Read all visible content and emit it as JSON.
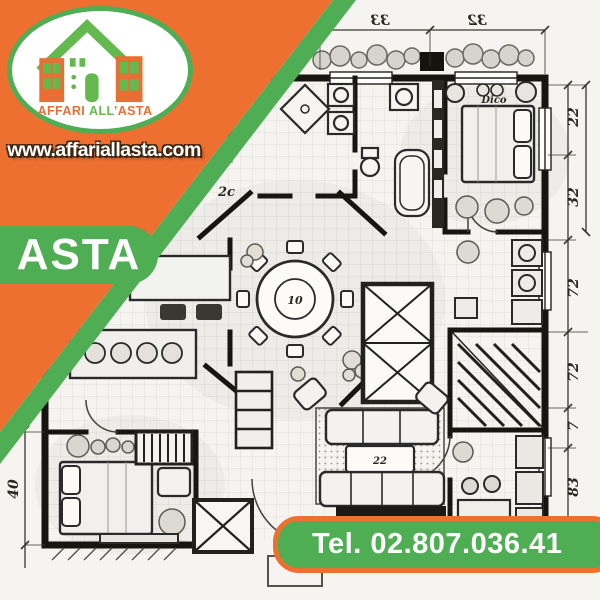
{
  "branding": {
    "logo_text": {
      "affari": "AFFARI",
      "all": "ALL",
      "asta": "’ASTA"
    },
    "website": "www.affariallasta.com",
    "badge": "ASTA",
    "phone": "Tel. 02.807.036.41"
  },
  "colors": {
    "orange": "#ee7030",
    "green": "#4fae54",
    "logo_green": "#63b84e",
    "logo_orange": "#e86f33",
    "paper": "#f5f4f0",
    "ink": "#23211c"
  },
  "floor_plan": {
    "dim_top": [
      "33",
      "32"
    ],
    "dim_right": [
      "22",
      "32",
      "72",
      "72",
      "7",
      "83"
    ],
    "dim_left": [
      "40"
    ],
    "labels": {
      "dining_table": "10",
      "bedroom": "Dico",
      "coffee_table": "22",
      "hall": "2c"
    }
  }
}
